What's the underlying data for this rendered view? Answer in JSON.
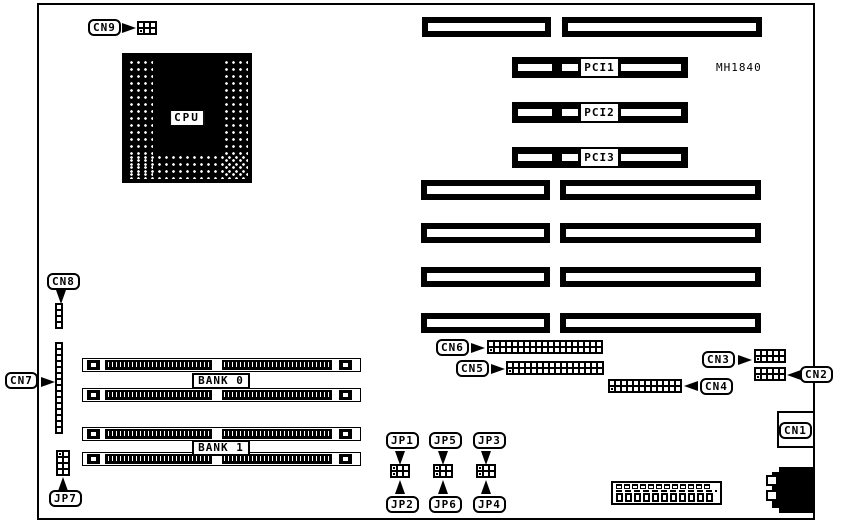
{
  "board": {
    "model": "MH1840"
  },
  "colors": {
    "foreground": "#000000",
    "background": "#ffffff"
  },
  "labels": {
    "cpu": "CPU",
    "cn1": "CN1",
    "cn2": "CN2",
    "cn3": "CN3",
    "cn4": "CN4",
    "cn5": "CN5",
    "cn6": "CN6",
    "cn7": "CN7",
    "cn8": "CN8",
    "cn9": "CN9",
    "jp1": "JP1",
    "jp2": "JP2",
    "jp3": "JP3",
    "jp4": "JP4",
    "jp5": "JP5",
    "jp6": "JP6",
    "jp7": "JP7",
    "pci1": "PCI1",
    "pci2": "PCI2",
    "pci3": "PCI3",
    "bank0": "BANK 0",
    "bank1": "BANK 1"
  }
}
